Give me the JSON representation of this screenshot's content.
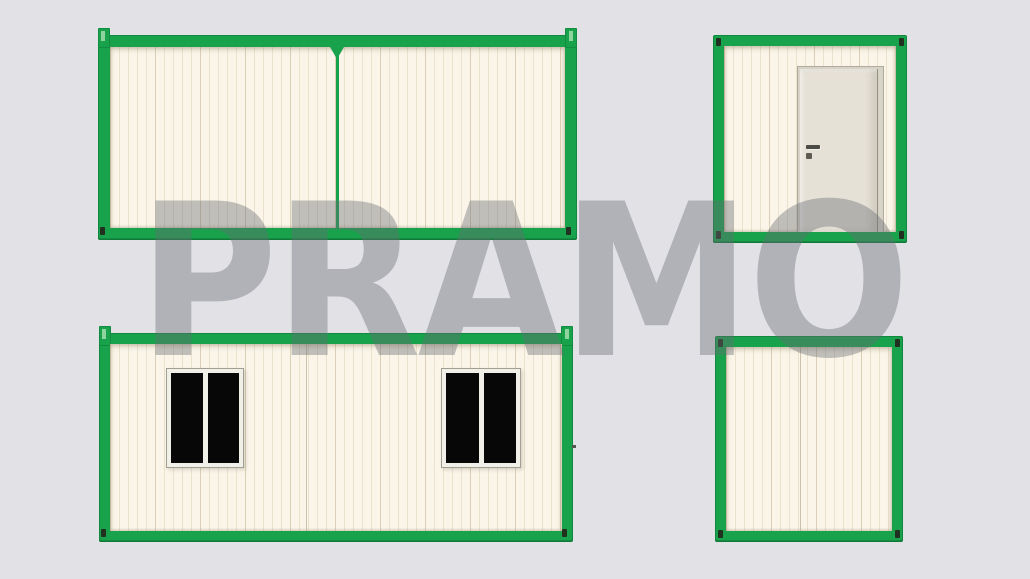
{
  "watermark": {
    "text": "PRAMO"
  },
  "colors": {
    "background": "#e2e2e6",
    "frame_green": "#18a24c",
    "frame_green_dark": "#0f7f3a",
    "frame_slot_light": "#8fd49f",
    "wall_cream": "#faf5e8",
    "wall_stripe": "#e3dac4",
    "door_frame": "#d8d3c7",
    "door_leaf": "#e6e1d6",
    "window_frame": "#f0efe8",
    "window_pane": "#070707",
    "corner_hole_dark": "#22301f",
    "watermark_gray": "rgba(105,108,116,0.40)"
  },
  "views": {
    "top_left": {
      "name": "long-side-elevation-joined-modules"
    },
    "top_right": {
      "name": "end-elevation-with-door"
    },
    "bottom_left": {
      "name": "long-side-elevation-two-windows"
    },
    "bottom_right": {
      "name": "end-elevation-plain"
    }
  }
}
